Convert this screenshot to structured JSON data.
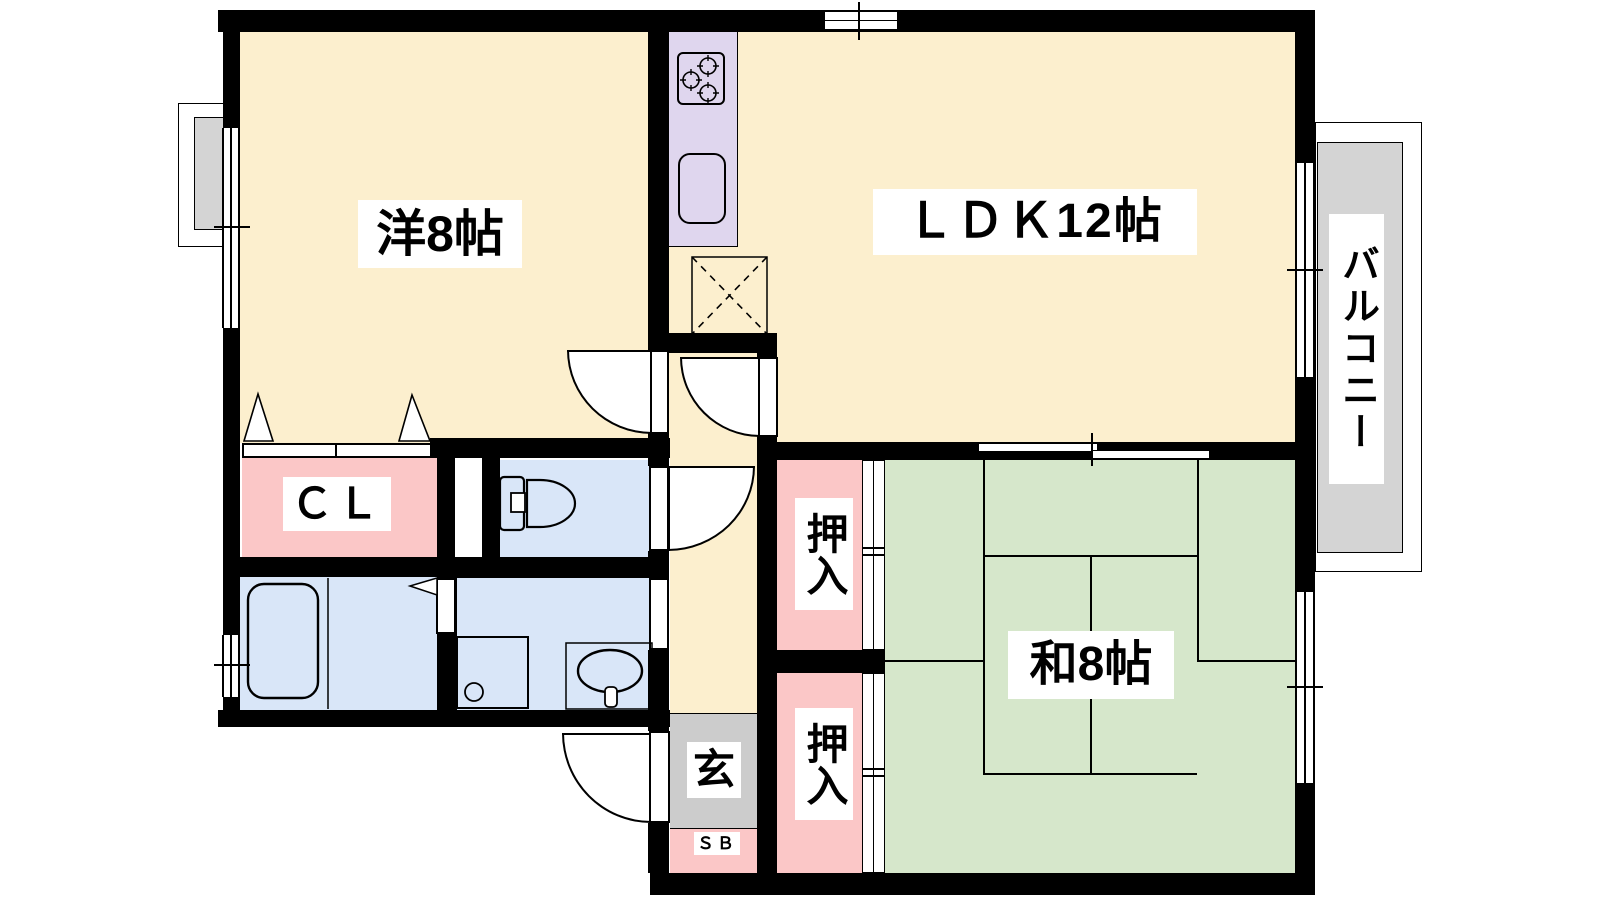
{
  "colors": {
    "wall": "#000000",
    "floor_cream": "#FCEFCE",
    "floor_pink": "#FBC7C7",
    "floor_blue": "#D9E6F8",
    "floor_green": "#D6E7CB",
    "kitchen_purple": "#DFD6EE",
    "balcony_gray": "#D4D4D4",
    "genkan_gray": "#CCCCCC",
    "label_bg": "#FFFFFF",
    "label_text": "#000000"
  },
  "rooms": {
    "western_room": {
      "label": "洋8帖"
    },
    "ldk": {
      "label": "ＬＤＫ12帖"
    },
    "japanese_room": {
      "label": "和8帖"
    },
    "balcony": {
      "label": "バルコニー"
    },
    "closet": {
      "label": "ＣＬ"
    },
    "oshiire_upper": {
      "label": "押入"
    },
    "oshiire_lower": {
      "label": "押入"
    },
    "entrance": {
      "label": "玄"
    },
    "shoe_box": {
      "label": "ＳＢ"
    }
  },
  "fixtures": [
    "stove-icon",
    "sink-icon",
    "refrigerator-space-icon",
    "toilet-icon",
    "bathtub-icon",
    "washbasin-icon",
    "washing-machine-pan-icon",
    "folding-door-icon",
    "hinged-door-icon",
    "sliding-door-icon",
    "window-icon"
  ]
}
